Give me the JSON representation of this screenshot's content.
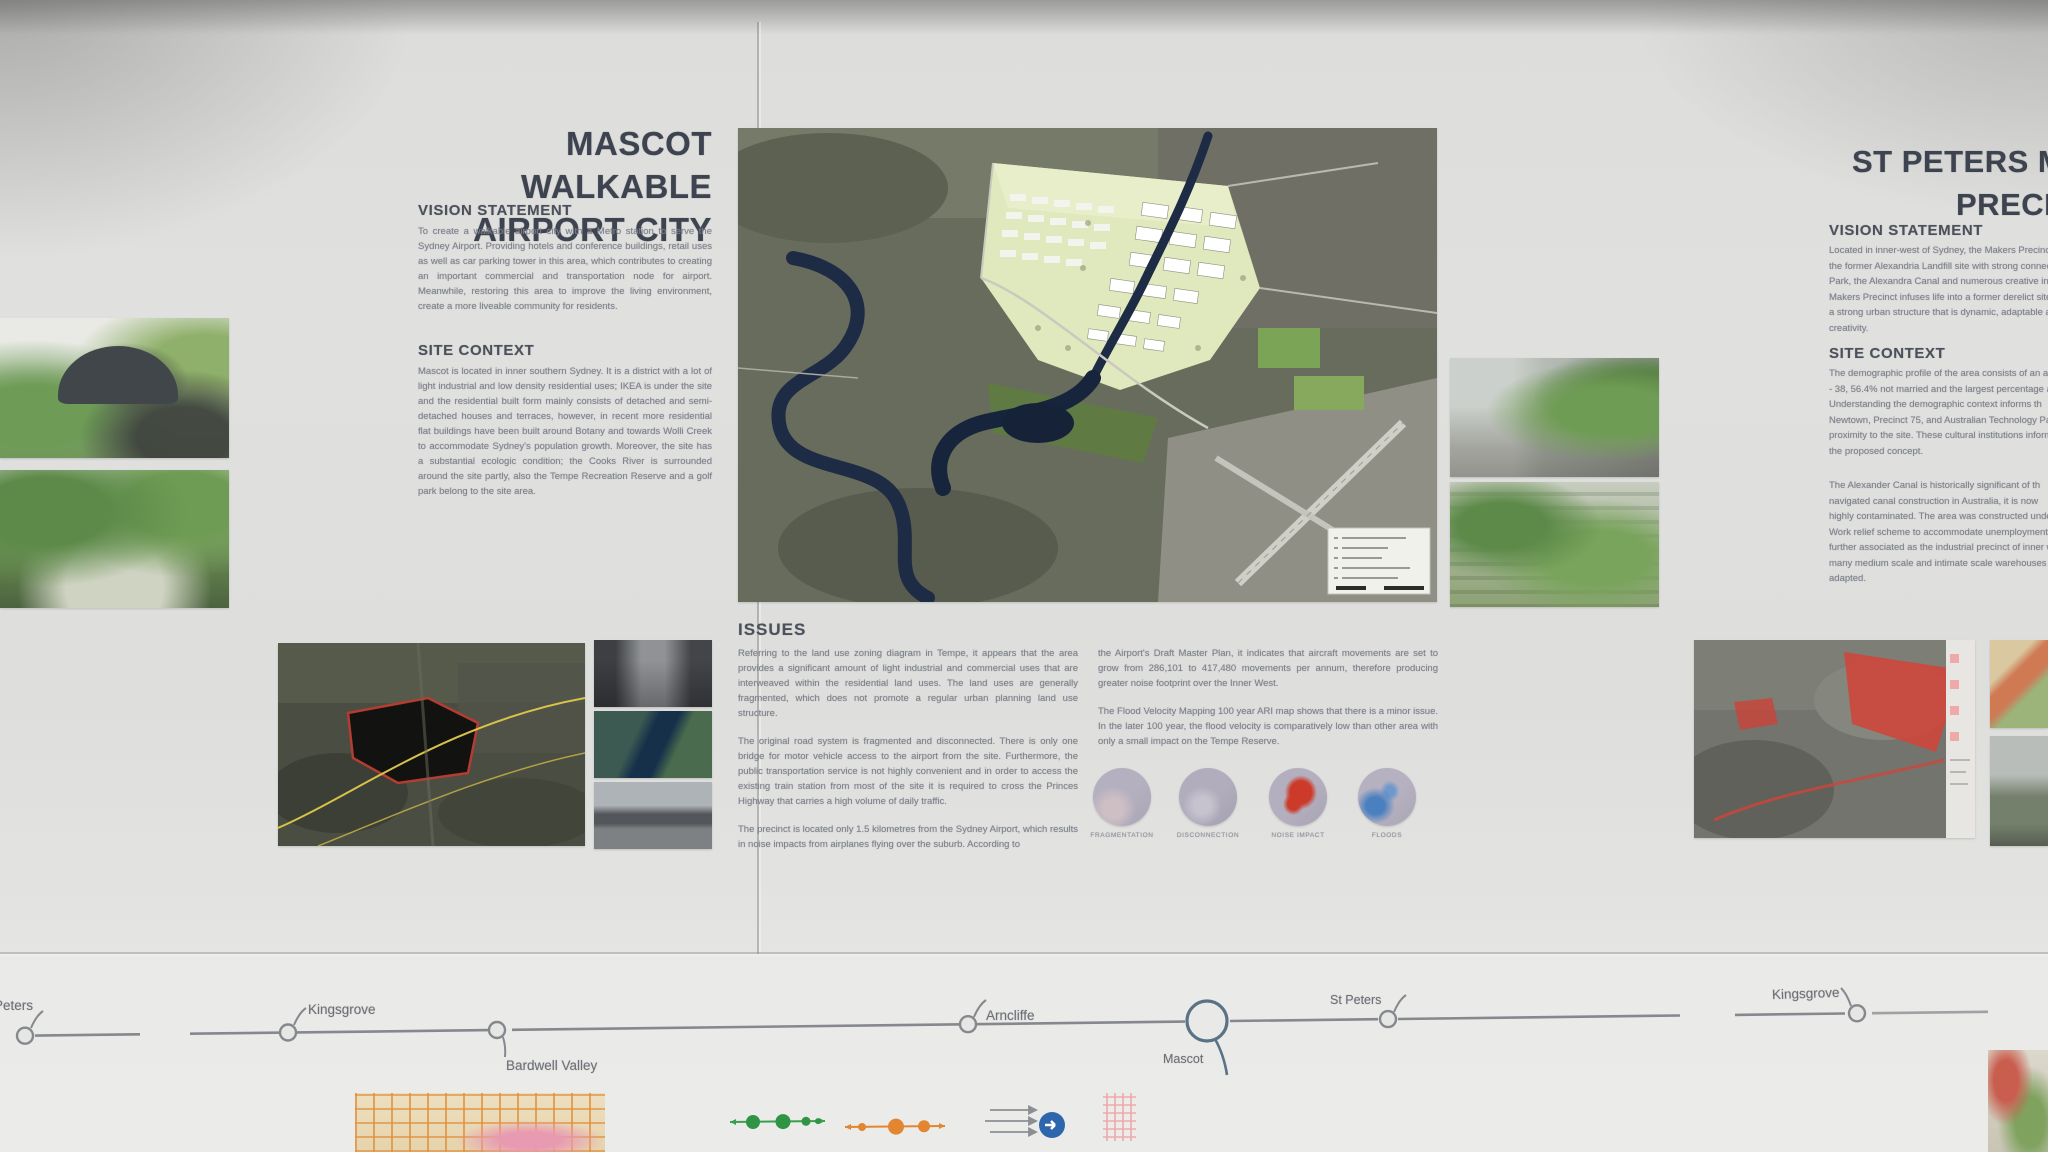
{
  "mascot_panel": {
    "title_line1": "MASCOT WALKABLE",
    "title_line2": "AIRPORT CITY",
    "vision_heading": "VISION STATEMENT",
    "vision_text": "To create a walkable airport city with a Metro station to serve the Sydney Airport. Providing hotels and conference buildings, retail uses as well as car parking tower in this area, which contributes to creating an important commercial and transportation node for airport. Meanwhile, restoring this area to improve the living environment, create a more liveable community for residents.",
    "context_heading": "SITE CONTEXT",
    "context_text": "Mascot is located in inner southern Sydney. It is a district with a lot of light industrial and low density residential uses; IKEA is under the site and the residential built form mainly consists of detached and semi-detached houses and terraces, however, in recent more residential flat buildings have been built around Botany and towards Wolli Creek to accommodate Sydney's population growth. Moreover, the site has a substantial ecologic condition; the Cooks River is surrounded around the site partly, also the Tempe Recreation Reserve and a golf park belong to the site area."
  },
  "issues": {
    "heading": "ISSUES",
    "col1_p1": "Referring to the land use zoning diagram in Tempe, it appears that the area provides a significant amount of light industrial and commercial uses that are interweaved within the residential land uses. The land uses are generally fragmented, which does not promote a regular urban planning land use structure.",
    "col1_p2": "The original road system is fragmented and disconnected. There is only one bridge for motor vehicle access to the airport from the site. Furthermore, the public transportation service is not highly convenient and in order to access the existing train station from most of the site it is required to cross the Princes Highway that carries a high volume of daily traffic.",
    "col1_p3": "The precinct is located only 1.5 kilometres from the Sydney Airport, which results in noise impacts from airplanes flying over the suburb. According to",
    "col2_p1": "the Airport's Draft Master Plan, it indicates that aircraft movements are set to grow from 286,101 to 417,480 movements per annum, therefore producing greater noise footprint over the Inner West.",
    "col2_p2": "The Flood Velocity Mapping 100 year ARI map shows that there is a minor issue. In the later 100 year, the flood velocity is comparatively low than other area with only a small impact on the Tempe Reserve.",
    "diagrams": [
      {
        "label": "FRAGMENTATION"
      },
      {
        "label": "DISCONNECTION"
      },
      {
        "label": "NOISE IMPACT"
      },
      {
        "label": "FLOODS"
      }
    ]
  },
  "st_peters_panel": {
    "title_line1": "ST PETERS MAKERS",
    "title_line2": "PRECINCT",
    "vision_heading": "VISION STATEMENT",
    "vision_lines": [
      "Located in inner-west of Sydney, the Makers Precinct",
      "the former Alexandria Landfill site with strong connectio",
      "Park, the Alexandra Canal and numerous creative ind",
      "Makers Precinct infuses life into a former derelict site w",
      "a strong urban structure that is dynamic, adaptable an",
      "creativity."
    ],
    "context_heading": "SITE CONTEXT",
    "context1_lines": [
      "The demographic profile of the area consists of an avera",
      "- 38, 56.4% not married and the largest percentage an",
      "Understanding the demographic context informs th",
      "Newtown, Precinct 75, and Australian Technology Par",
      "proximity to the site. These cultural institutions inform",
      "the proposed concept."
    ],
    "context2_lines": [
      "The Alexander Canal is historically significant of th",
      "navigated canal construction in Australia, it is now",
      "highly contaminated. The area was constructed unde",
      "Work relief scheme to accommodate unemployment",
      "further associated as the industrial precinct of inner wes",
      "many medium scale and intimate scale warehouses tha",
      "adapted."
    ]
  },
  "rail": {
    "stations": [
      {
        "label": "Peters"
      },
      {
        "label": "Kingsgrove"
      },
      {
        "label": "Bardwell Valley"
      },
      {
        "label": "Arncliffe"
      },
      {
        "label": "Mascot"
      },
      {
        "label": "St Peters"
      },
      {
        "label": "Kingsgrove"
      }
    ]
  },
  "legend": {
    "items": [
      "green-transit-line-icon",
      "orange-transit-line-icon",
      "flow-arrows-icon",
      "blue-direction-icon",
      "pink-hatch-area-icon"
    ]
  },
  "colors": {
    "heading": "#4b505b",
    "body_text": "#7c808a",
    "site_highlight": "#e0e8bd",
    "river": "#1d2b45",
    "issue_red": "#cc3b2a",
    "issue_blue": "#4a7fc0",
    "legend_green": "#3a9e4e",
    "legend_orange": "#e2862f",
    "legend_blue": "#2e66ae",
    "legend_pink": "#efa9a9"
  }
}
